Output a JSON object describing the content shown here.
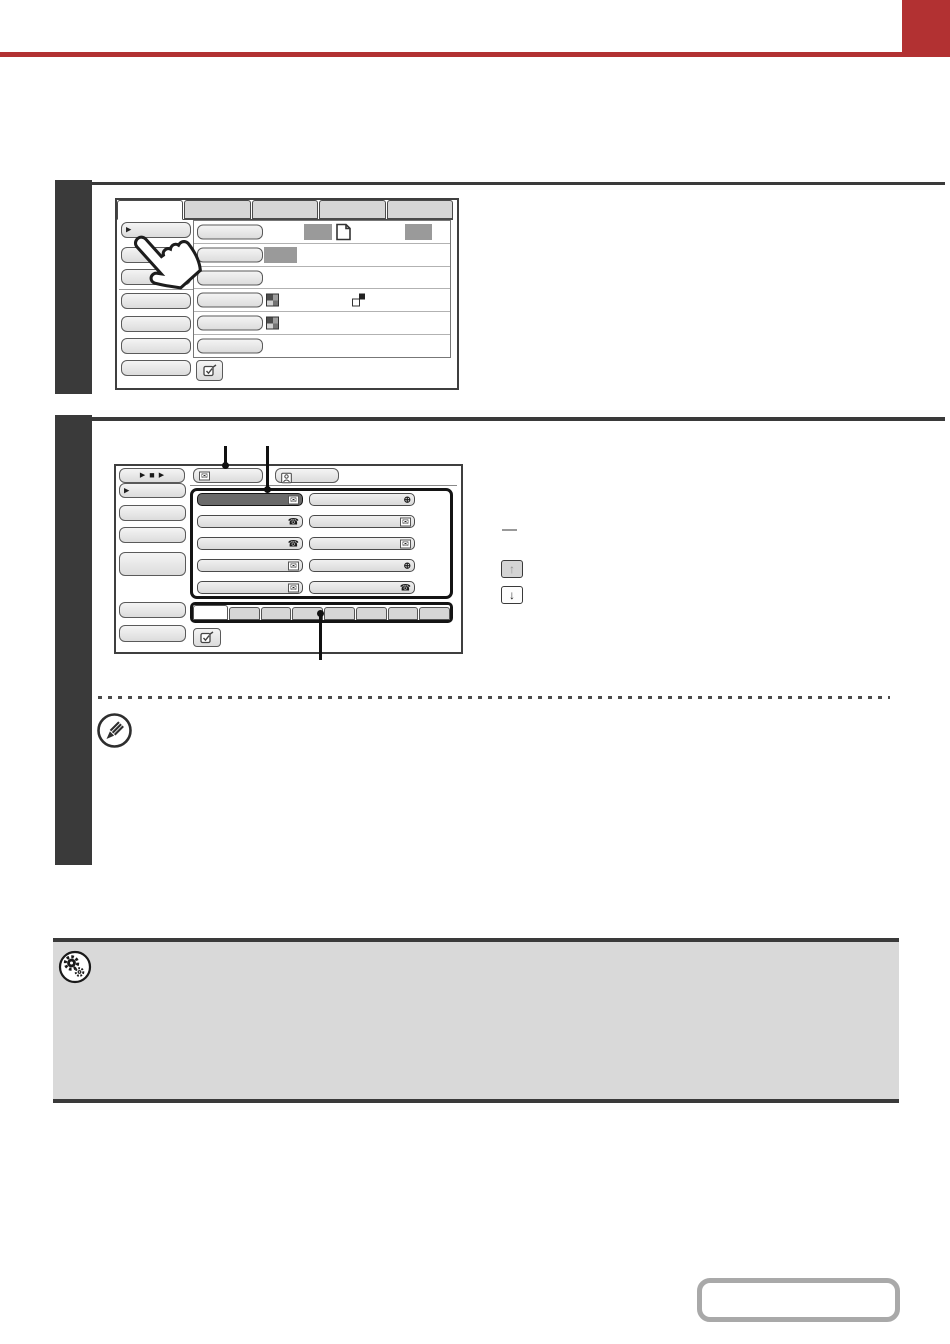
{
  "page": {
    "background": "#ffffff",
    "accent_color": "#b23132"
  },
  "icons": {
    "menu_arrow": "▶",
    "play": "▶",
    "stop": "■",
    "envelope": "✉",
    "phone": "☎",
    "globe": "⊕",
    "arrow_up": "↑",
    "arrow_down": "↓"
  },
  "step1": {
    "number": "",
    "bar_color": "#3a3a3a",
    "screen": {
      "mode_tabs": {
        "count": 5,
        "active_index": 0,
        "labels": [
          "",
          "",
          "",
          "",
          ""
        ]
      },
      "menu_buttons": [
        {
          "label": "",
          "has_arrow": true
        },
        {
          "label": ""
        },
        {
          "label": ""
        },
        {
          "label": ""
        },
        {
          "label": ""
        },
        {
          "label": ""
        },
        {
          "label": ""
        }
      ],
      "setting_rows": [
        {
          "label": "",
          "extras": [
            "value-placeholder",
            "original-icon",
            "value-placeholder"
          ]
        },
        {
          "label": "",
          "extras": [
            "value-placeholder"
          ]
        },
        {
          "label": "",
          "extras": []
        },
        {
          "label": "",
          "extras": [
            "color-mode-icon",
            "two-sided-icon"
          ]
        },
        {
          "label": "",
          "extras": [
            "color-mode-icon"
          ]
        },
        {
          "label": "",
          "extras": []
        }
      ],
      "placeholder_color": "#9a9a9a",
      "confirm_button_label": ""
    }
  },
  "step2": {
    "number": "",
    "bar_color": "#3a3a3a",
    "screen": {
      "resend_button": {
        "label": ""
      },
      "address_entry_button": {
        "label": "",
        "icon": "envelope"
      },
      "address_review_button": {
        "label": "",
        "icon": "person"
      },
      "menu_buttons": [
        {
          "label": "",
          "has_arrow": true
        },
        {
          "label": ""
        },
        {
          "label": ""
        },
        {
          "label": ""
        },
        {
          "label": ""
        },
        {
          "label": ""
        }
      ],
      "one_touch_keys": [
        {
          "label": "",
          "icon": "envelope",
          "selected": true
        },
        {
          "label": "",
          "icon": "globe",
          "selected": false
        },
        {
          "label": "",
          "icon": "phone",
          "selected": false
        },
        {
          "label": "",
          "icon": "envelope",
          "selected": false
        },
        {
          "label": "",
          "icon": "phone",
          "selected": false
        },
        {
          "label": "",
          "icon": "envelope",
          "selected": false
        },
        {
          "label": "",
          "icon": "envelope",
          "selected": false
        },
        {
          "label": "",
          "icon": "globe",
          "selected": false
        },
        {
          "label": "",
          "icon": "envelope",
          "selected": false
        },
        {
          "label": "",
          "icon": "phone",
          "selected": false
        }
      ],
      "index_tabs": {
        "count": 8,
        "active_index": 0
      },
      "scroll": {
        "up_disabled": true,
        "down_disabled": false
      },
      "confirm_button_label": ""
    },
    "callout_color": "#111111"
  },
  "note": {
    "divider_style": "dotted",
    "icon": "pencil"
  },
  "settings_note_box": {
    "background": "#d9d9d9",
    "border_color": "#3a3a3a",
    "icon": "gears",
    "text": ""
  },
  "nav_button": {
    "label": "",
    "border_color": "#a9a9a9"
  }
}
